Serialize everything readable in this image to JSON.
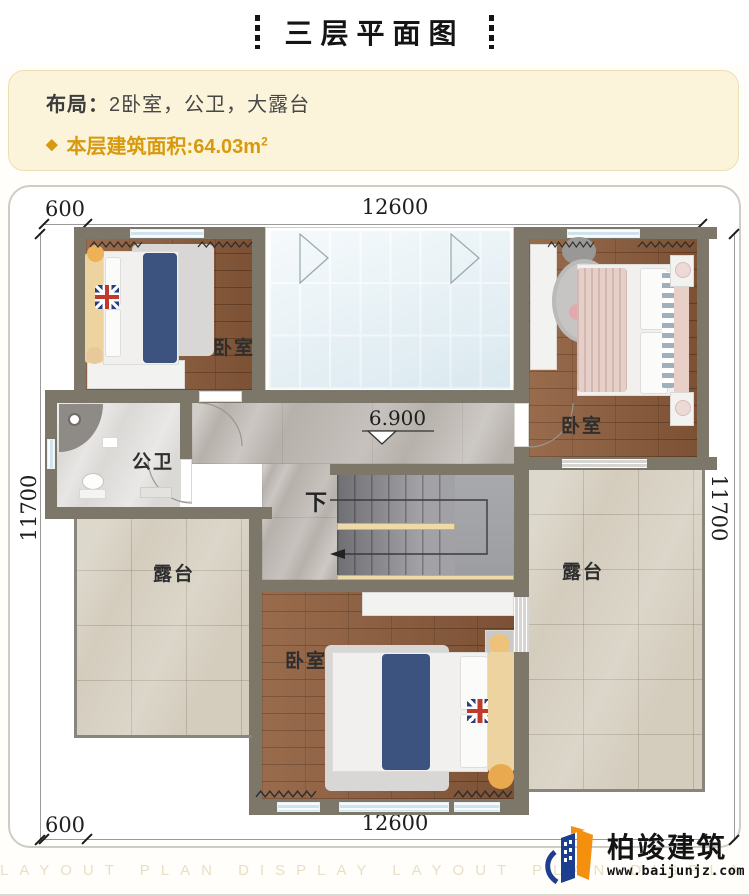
{
  "header": {
    "title": "三层平面图"
  },
  "info": {
    "layout_label": "布局：",
    "layout_value": "2卧室，公卫，大露台",
    "bullet": "◆",
    "area_label": "本层建筑面积:",
    "area_value": "64.03m",
    "area_superscript": "2",
    "accent_gold": "#d7990e"
  },
  "plan": {
    "dimensions": {
      "top_left": "600",
      "top_width": "12600",
      "left_height": "11700",
      "right_height": "11700",
      "bottom_left": "600",
      "bottom_width": "12600"
    },
    "rooms": {
      "bedroom_top_left": "卧室",
      "bedroom_top_right": "卧室",
      "bedroom_bottom": "卧室",
      "bathroom": "公卫",
      "terrace_left": "露台",
      "terrace_right": "露台"
    },
    "stairs": {
      "down_label": "下"
    },
    "elevation": {
      "value": "6.900"
    }
  },
  "footer": {
    "watermark": "LAYOUT PLAN DISPLAY LAYOUT PLAN DISPLAY",
    "logo": {
      "name": "柏竣建筑",
      "website": "www.baijunjz.com"
    }
  },
  "colors": {
    "wall": "#7c7769",
    "wood_floor": "#8a5a3a",
    "glass": "#e8f2f6",
    "accent_gold": "#d7990e",
    "logo_blue": "#1d3e8f",
    "logo_orange": "#f5900f"
  }
}
